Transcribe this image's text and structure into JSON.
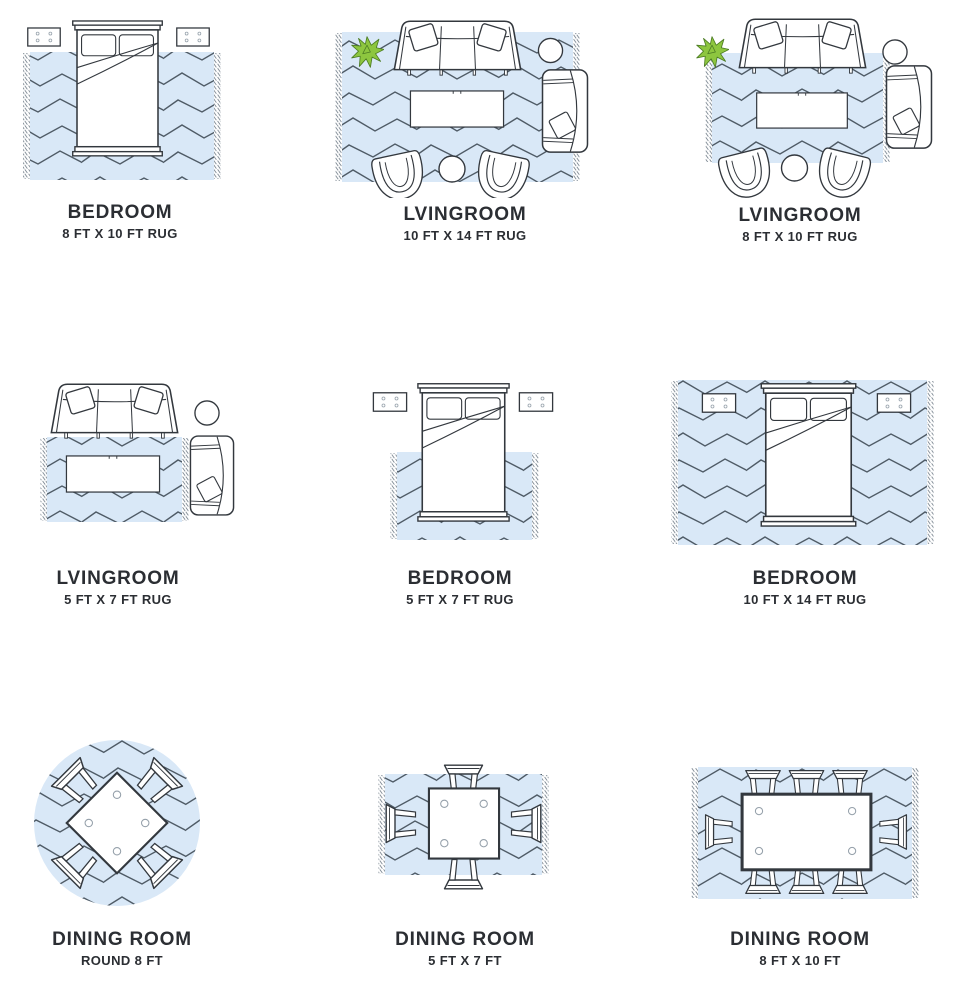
{
  "colors": {
    "background": "#ffffff",
    "rug_fill": "#d9e8f7",
    "rug_line": "#4f5b66",
    "fringe_line": "#7b8691",
    "furniture_line": "#33383e",
    "plant_fill": "#8dc63f",
    "plant_line": "#4c7c23",
    "label_text": "#2b2e33"
  },
  "cells": [
    {
      "room": "BEDROOM",
      "size": "8 FT X 10 FT RUG",
      "diagram": "bed-with-nightstands-on-8x10-rug"
    },
    {
      "room": "LVINGROOM",
      "size": "10 FT X 14 FT RUG",
      "diagram": "sofa-chairs-coffee-table-on-10x14-rug"
    },
    {
      "room": "LVINGROOM",
      "size": "8 FT X 10 FT RUG",
      "diagram": "sofa-chairs-coffee-table-on-8x10-rug"
    },
    {
      "room": "LVINGROOM",
      "size": "5 FT X 7 FT RUG",
      "diagram": "sofa-off-rug-coffee-table-on-5x7-rug"
    },
    {
      "room": "BEDROOM",
      "size": "5 FT X 7 FT RUG",
      "diagram": "bed-foot-on-5x7-rug"
    },
    {
      "room": "BEDROOM",
      "size": "10 FT X 14 FT RUG",
      "diagram": "bed-and-nightstands-on-10x14-rug"
    },
    {
      "room": "DINING ROOM",
      "size": "ROUND 8 FT",
      "diagram": "square-table-4-chairs-on-round-8ft-rug"
    },
    {
      "room": "DINING ROOM",
      "size": "5 FT X 7 FT",
      "diagram": "square-table-4-chairs-on-5x7-rug"
    },
    {
      "room": "DINING ROOM",
      "size": "8 FT X 10 FT",
      "diagram": "rect-table-8-chairs-on-8x10-rug"
    }
  ]
}
